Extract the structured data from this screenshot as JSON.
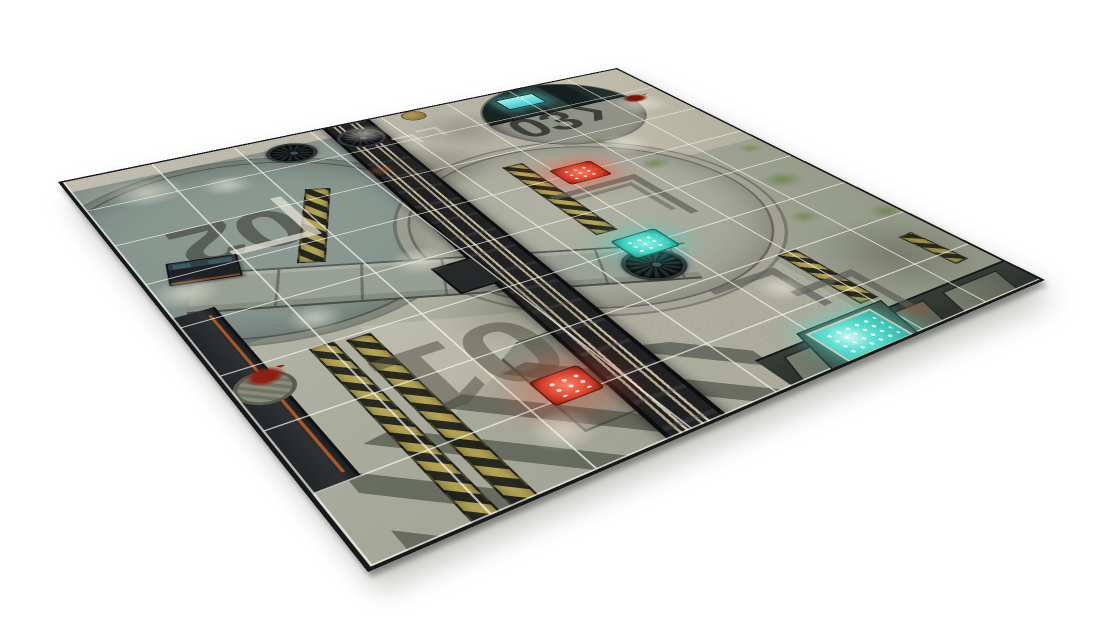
{
  "meta": {
    "image_type": "product-photo",
    "subject": "Sci-fi industrial wargaming battle mat displayed at a 3D perspective angle on a white background",
    "background_color": "#ffffff"
  },
  "mat": {
    "shape": "square mat viewed in perspective with black cut edge and drop shadow",
    "grid": {
      "rows": 8,
      "columns": 8,
      "line_color": "#f4f4ee"
    },
    "zones": [
      {
        "id": "zone-01",
        "label": "01",
        "marking_rotation": "180deg",
        "features": [
          "red-led-panel",
          "manhole-cover",
          "blood-splatter",
          "double-hazard-stripe",
          "diagonal-floor-stripes"
        ]
      },
      {
        "id": "zone-02",
        "label": "02",
        "marking_rotation": "180deg",
        "features": [
          "landing-circle",
          "supply-crate",
          "white-chevron",
          "hazard-stripe"
        ]
      },
      {
        "id": "zone-03",
        "label": "03",
        "arrow": "❯",
        "features": [
          "recessed-pit",
          "teal-glowing-screen",
          "machinery"
        ]
      }
    ],
    "colors": {
      "mat_edge": "#17181a",
      "concrete_light": "#bdbaaa",
      "concrete_mid": "#a8a99a",
      "panel_teal_grey": "#86938d",
      "mossy_concrete": "#99a08c",
      "moss_green": "#6e8249",
      "track_dark": "#202123",
      "rail_tan": "#c0b298",
      "hazard_yellow": "#b7a64f",
      "hazard_black": "#201f19",
      "glow_teal": "#4ad9c9",
      "glow_red": "#e8472f",
      "blood_red": "#7c150a",
      "rust_orange": "#a85728",
      "grid_white": "#f4f4ee",
      "wall_dark": "#2b2e2d",
      "pool_teal": "#3ecfc0"
    },
    "features": [
      "large-landing-pad-circle",
      "zone-02-landing-circle",
      "zone-03-equipment-pit",
      "rail-track",
      "metal-walkway",
      "hazard-stripe-bands",
      "vent-fans",
      "manhole-cover",
      "supply-crate",
      "red-led-dot-panels",
      "teal-led-dot-panels",
      "teal-coolant-pool",
      "blood-splatters",
      "moss-patches",
      "chevron-markings",
      "armored-wall-plates",
      "diagonal-floor-stripes",
      "maintenance-emblem"
    ]
  }
}
